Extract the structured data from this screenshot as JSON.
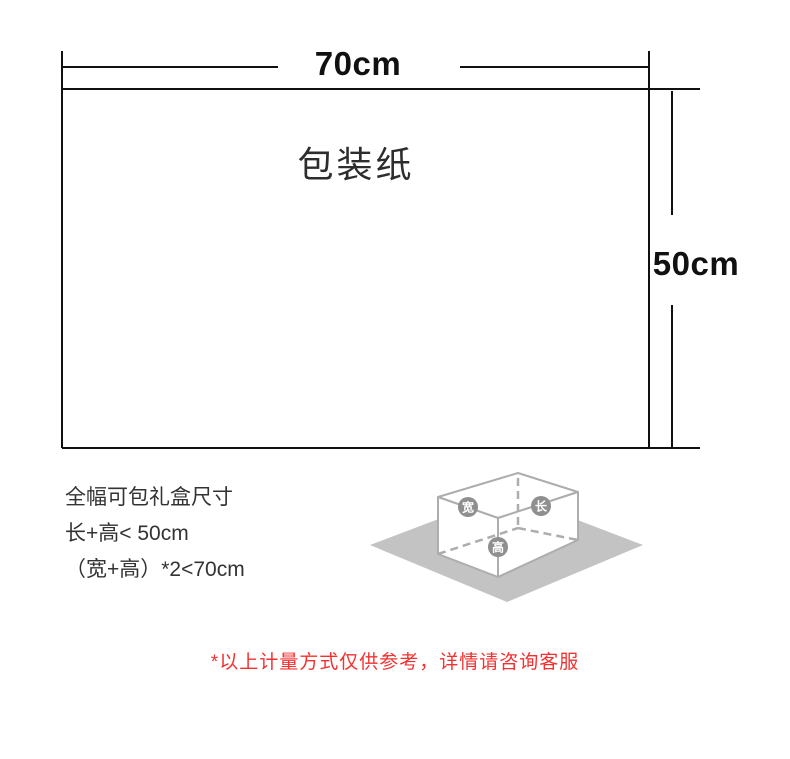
{
  "diagram": {
    "paper_label": "包装纸",
    "width_label": "70cm",
    "height_label": "50cm"
  },
  "specs": {
    "title": "全幅可包礼盒尺寸",
    "rule_height": "长+高< 50cm",
    "rule_width": "（宽+高）*2<70cm"
  },
  "illustration": {
    "width_badge": "宽",
    "length_badge": "长",
    "height_badge": "高"
  },
  "footnote": "*以上计量方式仅供参考，详情请咨询客服",
  "colors": {
    "dimension_line": "#111111",
    "paper_label_text": "#2d2d2d",
    "spec_text": "#333333",
    "note_red": "#f53030",
    "box_line_gray": "#adadad",
    "ground_gray": "#c3c3c3",
    "badge_gray": "#8f8f8f"
  }
}
